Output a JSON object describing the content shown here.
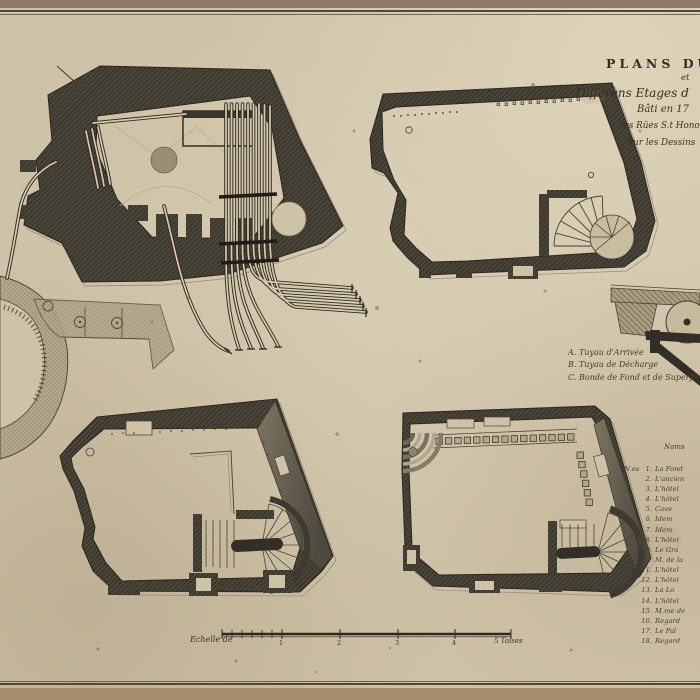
{
  "colors": {
    "mount_top": "#8d7a67",
    "mount_bottom": "#a48c6e",
    "paper": "#cfc3a7",
    "ink": "#3b3227",
    "wall_dark": "#4a4539",
    "wall_band_light": "#7b7363",
    "stipple": "#b3a78a"
  },
  "title": {
    "line1": "PLANS DU",
    "line2": "et",
    "line3": "Différens Etages d",
    "line4": "Bâti en 17",
    "line5": "des Rües S.t Honoré",
    "line6": "Sur les Dessins"
  },
  "legend": {
    "items": [
      {
        "key": "A.",
        "label": "Tuyau d'Arrivée"
      },
      {
        "key": "B.",
        "label": "Tuyau de Décharge"
      },
      {
        "key": "C.",
        "label": "Bonde de Fond et de Superficie"
      }
    ]
  },
  "notes": {
    "heading": "Noms",
    "numero_prefix": "N.os",
    "items": [
      {
        "num": "1.",
        "label": "La Fond"
      },
      {
        "num": "2.",
        "label": "L'ancien"
      },
      {
        "num": "3.",
        "label": "L'hôtel"
      },
      {
        "num": "4.",
        "label": "L'hôtel"
      },
      {
        "num": "5.",
        "label": "Cave"
      },
      {
        "num": "6.",
        "label": "Idem"
      },
      {
        "num": "7.",
        "label": "Idem"
      },
      {
        "num": "8.",
        "label": "L'hôtel"
      },
      {
        "num": "9.",
        "label": "Le Gra"
      },
      {
        "num": "10.",
        "label": "M. de la"
      },
      {
        "num": "11.",
        "label": "L'hôtel"
      },
      {
        "num": "12.",
        "label": "L'hôtel"
      },
      {
        "num": "13.",
        "label": "La Lo"
      },
      {
        "num": "14.",
        "label": "L'hôtel"
      },
      {
        "num": "15.",
        "label": "M.me de"
      },
      {
        "num": "16.",
        "label": "Regard"
      },
      {
        "num": "17.",
        "label": "Le Pal"
      },
      {
        "num": "18.",
        "label": "Regard"
      }
    ]
  },
  "scale_bar": {
    "label": "Echelle de",
    "ticks": [
      "1",
      "2",
      "3",
      "4"
    ],
    "end_label": "5 Toises"
  }
}
